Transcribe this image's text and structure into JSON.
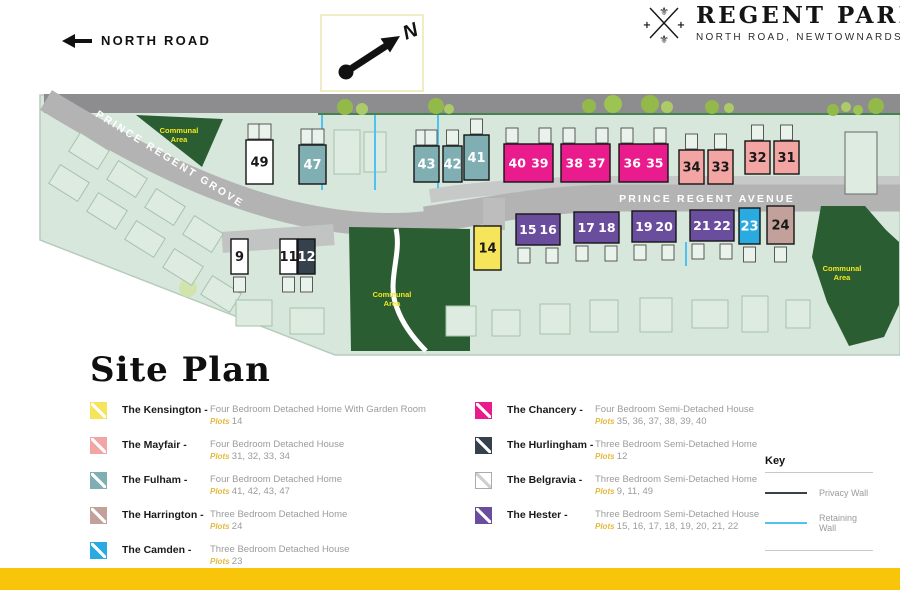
{
  "header": {
    "north_road": "NORTH ROAD",
    "compass_n": "N",
    "logo_title": "REGENT PARK",
    "logo_subtitle": "NORTH ROAD, NEWTOWNARDS"
  },
  "map": {
    "street_grove": "PRINCE REGENT GROVE",
    "street_avenue": "PRINCE REGENT AVENUE",
    "communal_line1": "Communal",
    "communal_line2": "Area",
    "plots": [
      {
        "label": "49",
        "type": "belgravia",
        "x": 246,
        "y": 140,
        "w": 27,
        "h": 44,
        "row": "upper",
        "g": 2
      },
      {
        "label": "47",
        "type": "fulham",
        "x": 299,
        "y": 145,
        "w": 27,
        "h": 39,
        "row": "upper",
        "g": 2
      },
      {
        "label": "43",
        "type": "fulham",
        "x": 414,
        "y": 146,
        "w": 25,
        "h": 36,
        "row": "upper",
        "g": 2
      },
      {
        "label": "42",
        "type": "fulham",
        "x": 443,
        "y": 146,
        "w": 19,
        "h": 36,
        "row": "upper",
        "g": 1
      },
      {
        "label": "41",
        "type": "fulham",
        "x": 464,
        "y": 135,
        "w": 25,
        "h": 45,
        "row": "upper",
        "g": 1
      },
      {
        "label": "40 39",
        "type": "chancery",
        "x": 504,
        "y": 144,
        "w": 49,
        "h": 38,
        "row": "upper",
        "g": 2
      },
      {
        "label": "38 37",
        "type": "chancery",
        "x": 561,
        "y": 144,
        "w": 49,
        "h": 38,
        "row": "upper",
        "g": 2
      },
      {
        "label": "36 35",
        "type": "chancery",
        "x": 619,
        "y": 144,
        "w": 49,
        "h": 38,
        "row": "upper",
        "g": 2
      },
      {
        "label": "34",
        "type": "mayfair",
        "x": 679,
        "y": 150,
        "w": 25,
        "h": 34,
        "row": "upper",
        "g": 1
      },
      {
        "label": "33",
        "type": "mayfair",
        "x": 708,
        "y": 150,
        "w": 25,
        "h": 34,
        "row": "upper",
        "g": 1
      },
      {
        "label": "32",
        "type": "mayfair",
        "x": 745,
        "y": 141,
        "w": 25,
        "h": 33,
        "row": "upper",
        "g": 1
      },
      {
        "label": "31",
        "type": "mayfair",
        "x": 774,
        "y": 141,
        "w": 25,
        "h": 33,
        "row": "upper",
        "g": 1
      },
      {
        "label": "9",
        "type": "belgravia",
        "x": 231,
        "y": 239,
        "w": 17,
        "h": 35,
        "row": "lower",
        "g": 1
      },
      {
        "label": "11",
        "type": "belgravia",
        "x": 280,
        "y": 239,
        "w": 17,
        "h": 35,
        "row": "lower",
        "g": 1
      },
      {
        "label": "12",
        "type": "hurlingham",
        "x": 298,
        "y": 239,
        "w": 17,
        "h": 35,
        "row": "lower",
        "g": 1
      },
      {
        "label": "14",
        "type": "kensington",
        "x": 474,
        "y": 226,
        "w": 27,
        "h": 44,
        "row": "lower",
        "g": 0
      },
      {
        "label": "15 16",
        "type": "hester",
        "x": 516,
        "y": 214,
        "w": 44,
        "h": 31,
        "row": "lower",
        "g": 2
      },
      {
        "label": "17 18",
        "type": "hester",
        "x": 574,
        "y": 212,
        "w": 45,
        "h": 31,
        "row": "lower",
        "g": 2
      },
      {
        "label": "19 20",
        "type": "hester",
        "x": 632,
        "y": 211,
        "w": 44,
        "h": 31,
        "row": "lower",
        "g": 2
      },
      {
        "label": "21 22",
        "type": "hester",
        "x": 690,
        "y": 210,
        "w": 44,
        "h": 31,
        "row": "lower",
        "g": 2
      },
      {
        "label": "23",
        "type": "camden",
        "x": 739,
        "y": 208,
        "w": 21,
        "h": 36,
        "row": "lower",
        "g": 1
      },
      {
        "label": "24",
        "type": "harrington",
        "x": 767,
        "y": 206,
        "w": 27,
        "h": 38,
        "row": "lower",
        "g": 1
      }
    ]
  },
  "house_types": {
    "kensington": {
      "color": "#F6E45A",
      "text": "#191919"
    },
    "mayfair": {
      "color": "#F2A5A2",
      "text": "#191919"
    },
    "fulham": {
      "color": "#7FAFB3",
      "text": "#FFFFFF"
    },
    "harrington": {
      "color": "#C2A19B",
      "text": "#191919"
    },
    "camden": {
      "color": "#29ABE2",
      "text": "#FFFFFF"
    },
    "chancery": {
      "color": "#EA1B8D",
      "text": "#FFFFFF"
    },
    "hurlingham": {
      "color": "#35424E",
      "text": "#FFFFFF"
    },
    "belgravia": {
      "color": "#FFFFFF",
      "text": "#191919",
      "stripe": "#CFCFCF",
      "border": "#ABABAB"
    },
    "hester": {
      "color": "#6B4D9E",
      "text": "#FFFFFF"
    }
  },
  "site_plan": {
    "heading": "Site Plan",
    "plots_label": "Plots",
    "legend_columns": [
      [
        {
          "type": "kensington",
          "name": "The Kensington -",
          "desc": "Four Bedroom Detached Home With Garden Room",
          "plots": "14"
        },
        {
          "type": "mayfair",
          "name": "The Mayfair -",
          "desc": "Four Bedroom Detached House",
          "plots": "31, 32, 33, 34"
        },
        {
          "type": "fulham",
          "name": "The Fulham -",
          "desc": "Four Bedroom Detached Home",
          "plots": "41, 42, 43, 47"
        },
        {
          "type": "harrington",
          "name": "The Harrington -",
          "desc": "Three Bedroom Detached Home",
          "plots": "24"
        },
        {
          "type": "camden",
          "name": "The Camden -",
          "desc": "Three Bedroom Detached House",
          "plots": "23"
        }
      ],
      [
        {
          "type": "chancery",
          "name": "The Chancery -",
          "desc": "Four Bedroom Semi-Detached House",
          "plots": "35, 36, 37, 38, 39, 40"
        },
        {
          "type": "hurlingham",
          "name": "The Hurlingham -",
          "desc": "Three Bedroom Semi-Detached Home",
          "plots": "12"
        },
        {
          "type": "belgravia",
          "name": "The Belgravia -",
          "desc": "Three Bedroom Semi-Detached Home",
          "plots": "9, 11, 49"
        },
        {
          "type": "hester",
          "name": "The Hester -",
          "desc": "Three Bedroom Semi-Detached House",
          "plots": "15, 16, 17, 18, 19, 20, 21, 22"
        }
      ]
    ]
  },
  "key": {
    "heading": "Key",
    "items": [
      {
        "label": "Privacy Wall",
        "color": "#3A4147"
      },
      {
        "label": "Retaining Wall",
        "color": "#4FC3F0"
      }
    ]
  },
  "colors": {
    "footer_bar": "#F8C50A",
    "communal_green": "#2B5D32",
    "map_background": "#D8E7DC",
    "road_gray": "#B3B3B4",
    "top_road_gray": "#8D8D8F",
    "communal_label_yellow": "#F3E71F",
    "plots_label_yellow": "#E2B93B",
    "retaining_wall_blue": "#4FC3F0",
    "privacy_wall_dark": "#3A4147"
  }
}
